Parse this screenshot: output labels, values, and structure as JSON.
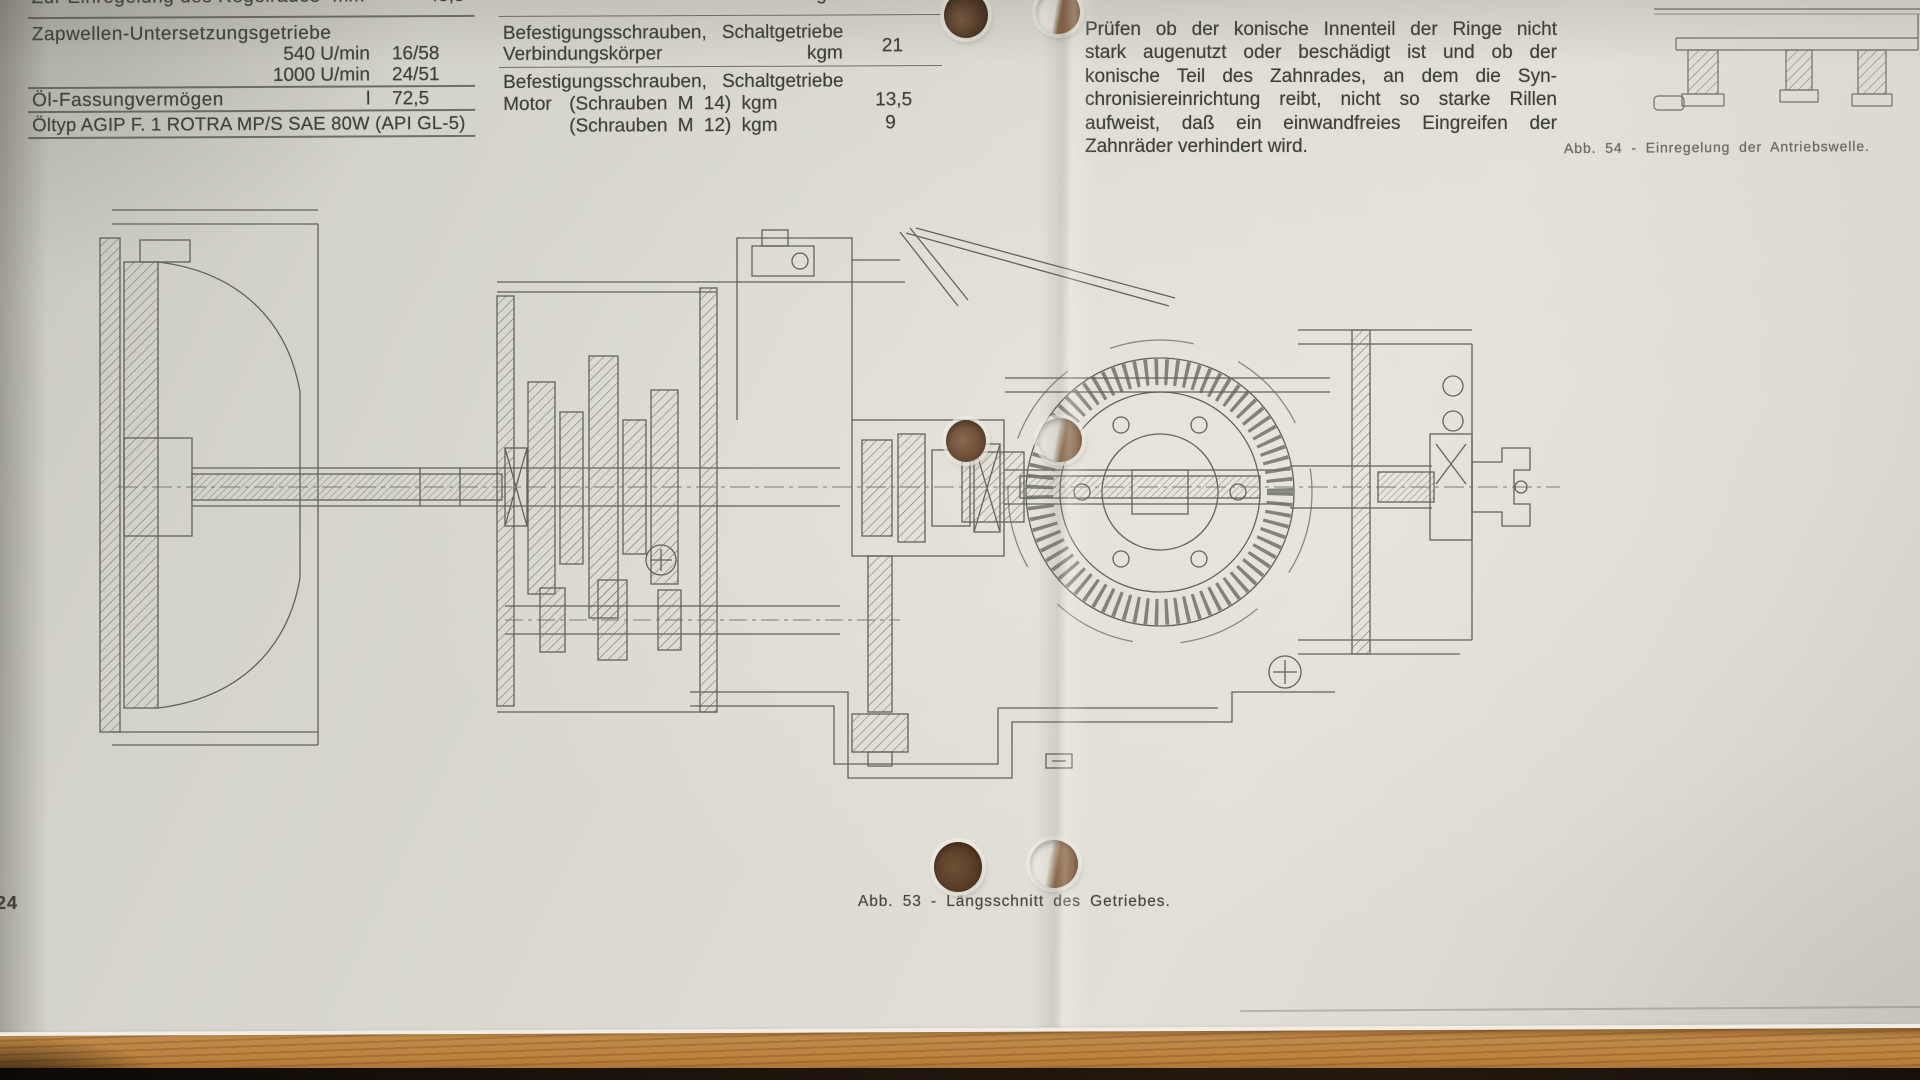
{
  "page": {
    "number": "24"
  },
  "colors": {
    "paper": "#dcdad2",
    "ink": "#41413b",
    "drawing_line": "#585951",
    "wood": "#bd8343",
    "wood_shadow": "#1a110a",
    "hole_brown": "#6e4f36"
  },
  "spec_table": {
    "cut_row": {
      "label": "Zur Einregelung des Regelrades",
      "unit": "mm",
      "value": "45,5"
    },
    "section_label": "Zapwellen-Untersetzungsgetriebe",
    "pto_rows": [
      {
        "speed": "540 U/min",
        "ratio": "16/58"
      },
      {
        "speed": "1000 U/min",
        "ratio": "24/51"
      }
    ],
    "oil_capacity": {
      "label": "Öl-Fassungvermögen",
      "unit": "l",
      "value": "72,5"
    },
    "oil_type": "Öltyp AGIP F. 1 ROTRA MP/S SAE 80W (API GL-5)"
  },
  "torque_table": {
    "cut_row": {
      "unit": "kgm",
      "value": "9"
    },
    "row_connector": {
      "line1_left": "Befestigungsschrauben,",
      "line1_right": "Schaltgetriebe",
      "line2_left": "Verbindungskörper",
      "line2_unit": "kgm",
      "value": "21"
    },
    "row_motor": {
      "line1_left": "Befestigungsschrauben,",
      "line1_right": "Schaltgetriebe",
      "line2_left": "Motor",
      "line2_mid": "(Schrauben M 14) kgm",
      "line2_value": "13,5",
      "line3_mid": "(Schrauben M 12) kgm",
      "line3_value": "9"
    }
  },
  "right_text": {
    "lines": [
      "Prüfen ob der konische Innenteil der Ringe nicht",
      "stark augenutzt oder beschädigt ist und ob der",
      "konische Teil des Zahnrades, an dem die Syn-",
      "chronisiereinrichtung reibt, nicht so starke Rillen",
      "aufweist, daß ein einwandfreies Eingreifen der",
      "Zahnräder verhindert wird."
    ]
  },
  "captions": {
    "fig53": "Abb. 53 - Längsschnitt des Getriebes.",
    "fig54": "Abb. 54 - Einregelung der Antriebswelle."
  }
}
